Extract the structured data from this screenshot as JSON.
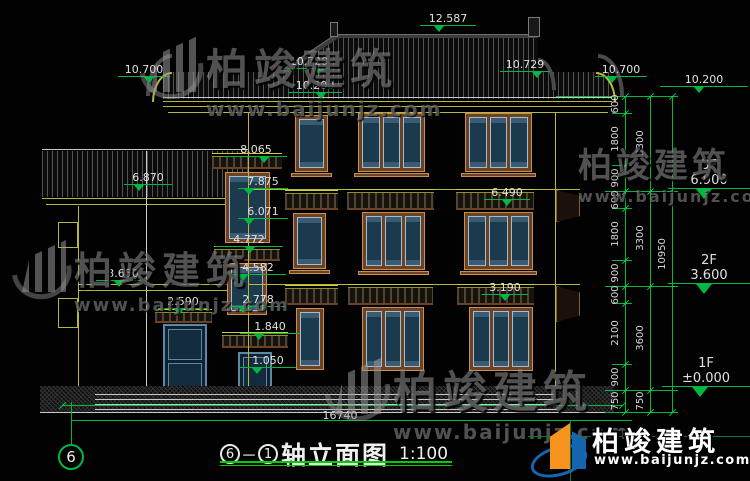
{
  "watermark": {
    "name": "柏竣建筑",
    "url": "www.baijunjz.com"
  },
  "logo": {
    "name": "柏竣建筑",
    "url": "www.baijunjz.com"
  },
  "title": {
    "axis_start": "6",
    "axis_end": "1",
    "text": "轴立面图",
    "scale": "1:100"
  },
  "axis_bubble": "6",
  "ground_dim": "16740",
  "elevations": {
    "ridge": "12.587",
    "eave_left": "10.700",
    "eave_left_inner": "10.729",
    "eave_left_low": "10.200",
    "eave_right_inner": "10.729",
    "eave_right": "10.700",
    "annex_roof": "6.870",
    "annex_floor": "3.650",
    "annex_door": "2.590",
    "sw_awn3": "8.065",
    "sw_top3": "7.875",
    "sw_bot3": "6.071",
    "sw_awn2": "4.772",
    "sw_top2": "4.582",
    "sw_bot2": "2.778",
    "sw_awn1": "1.840",
    "sw_top1": "1.050",
    "fac_2f": "6.490",
    "fac_1f": "3.190"
  },
  "right_panel": {
    "top": "10.200",
    "floors": [
      {
        "name": "3F",
        "elev": "6.900"
      },
      {
        "name": "2F",
        "elev": "3.600"
      },
      {
        "name": "1F",
        "elev": "±0.000"
      }
    ],
    "chain_col1": [
      "600",
      "1800",
      "900",
      "600",
      "1800",
      "900",
      "600",
      "2100",
      "900",
      "750"
    ],
    "chain_col2": [
      "3300",
      "3300",
      "3600",
      "750"
    ],
    "chain_col3": [
      "10950"
    ]
  },
  "colors": {
    "dim_green": "#00b841",
    "line_yellow": "#b8b83a",
    "window_blue": "#5d87a5",
    "frame_brown": "#6b4226"
  }
}
